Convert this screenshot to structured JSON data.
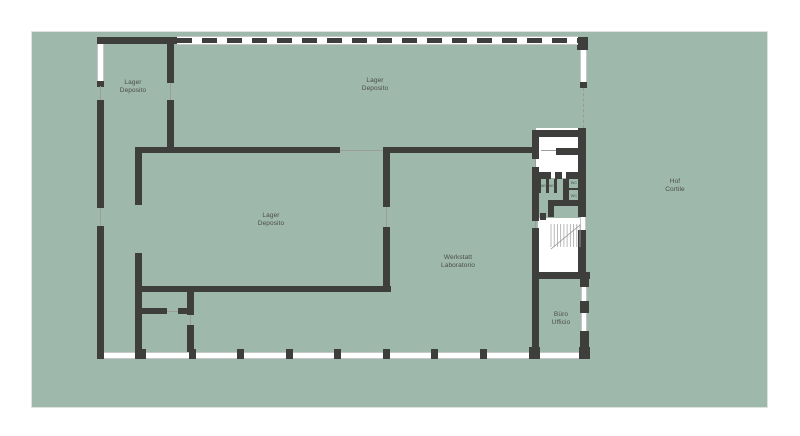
{
  "colors": {
    "page_background": "#ffffff",
    "site_field": "#9eb8ac",
    "wall": "#3e3e3c",
    "room_fill": "#ffffff",
    "window_frame": "#c7c7c7",
    "thin_line": "#9c9c9c",
    "label_text": "#4d4d4d"
  },
  "plan": {
    "field": {
      "x": 32,
      "y": 32,
      "w": 735,
      "h": 375
    },
    "dashed_wall": {
      "x": 177,
      "y": 36,
      "w": 401,
      "h": 9
    },
    "stairs": {
      "x": 551,
      "y": 224,
      "w": 29,
      "h": 25,
      "steps": 9
    },
    "rects": [
      {
        "t": "white",
        "x": 536,
        "y": 128,
        "w": 50,
        "h": 50,
        "n": "room-fill-entry"
      },
      {
        "t": "white",
        "x": 538,
        "y": 218,
        "w": 42,
        "h": 61,
        "n": "room-fill-stairwell"
      },
      {
        "t": "win-v",
        "x": 97,
        "y": 44,
        "w": 7,
        "h": 37,
        "n": "window-west-top"
      },
      {
        "t": "win-v",
        "x": 580,
        "y": 50,
        "w": 7,
        "h": 33,
        "n": "window-east-top"
      },
      {
        "t": "win-h",
        "x": 97,
        "y": 352,
        "w": 493,
        "h": 7,
        "n": "window-band-south"
      },
      {
        "t": "win-v",
        "x": 580,
        "y": 217,
        "w": 6,
        "h": 13,
        "n": "window-east-stair"
      },
      {
        "t": "win-v",
        "x": 581,
        "y": 287,
        "w": 6,
        "h": 14,
        "n": "window-east-office-1"
      },
      {
        "t": "win-v",
        "x": 581,
        "y": 313,
        "w": 6,
        "h": 18,
        "n": "window-east-office-2"
      },
      {
        "t": "wall",
        "x": 97,
        "y": 37,
        "w": 80,
        "h": 7
      },
      {
        "t": "wall",
        "x": 577,
        "y": 37,
        "w": 11,
        "h": 13
      },
      {
        "t": "wall",
        "x": 97,
        "y": 81,
        "w": 7,
        "h": 6
      },
      {
        "t": "wall",
        "x": 97,
        "y": 100,
        "w": 7,
        "h": 108
      },
      {
        "t": "wall",
        "x": 97,
        "y": 226,
        "w": 7,
        "h": 126
      },
      {
        "t": "wall",
        "x": 167,
        "y": 37,
        "w": 7,
        "h": 46
      },
      {
        "t": "wall",
        "x": 167,
        "y": 100,
        "w": 7,
        "h": 53
      },
      {
        "t": "wall",
        "x": 135,
        "y": 147,
        "w": 205,
        "h": 6
      },
      {
        "t": "wall",
        "x": 383,
        "y": 147,
        "w": 152,
        "h": 6
      },
      {
        "t": "wall",
        "x": 135,
        "y": 147,
        "w": 7,
        "h": 58
      },
      {
        "t": "wall",
        "x": 135,
        "y": 253,
        "w": 7,
        "h": 106
      },
      {
        "t": "wall",
        "x": 383,
        "y": 147,
        "w": 7,
        "h": 60
      },
      {
        "t": "wall",
        "x": 383,
        "y": 227,
        "w": 7,
        "h": 65
      },
      {
        "t": "wall",
        "x": 139,
        "y": 286,
        "w": 252,
        "h": 6
      },
      {
        "t": "wall",
        "x": 187,
        "y": 292,
        "w": 7,
        "h": 23
      },
      {
        "t": "wall",
        "x": 139,
        "y": 308,
        "w": 28,
        "h": 6
      },
      {
        "t": "wall",
        "x": 178,
        "y": 308,
        "w": 16,
        "h": 6
      },
      {
        "t": "wall",
        "x": 187,
        "y": 325,
        "w": 7,
        "h": 27
      },
      {
        "t": "wall",
        "x": 580,
        "y": 82,
        "w": 7,
        "h": 6
      },
      {
        "t": "wall",
        "x": 532,
        "y": 130,
        "w": 7,
        "h": 29
      },
      {
        "t": "wall",
        "x": 532,
        "y": 167,
        "w": 7,
        "h": 54
      },
      {
        "t": "wall",
        "x": 532,
        "y": 228,
        "w": 7,
        "h": 131
      },
      {
        "t": "wall",
        "x": 536,
        "y": 130,
        "w": 46,
        "h": 7
      },
      {
        "t": "wall",
        "x": 578,
        "y": 128,
        "w": 8,
        "h": 89
      },
      {
        "t": "wall",
        "x": 556,
        "y": 148,
        "w": 26,
        "h": 7
      },
      {
        "t": "wall",
        "x": 539,
        "y": 172,
        "w": 12,
        "h": 7
      },
      {
        "t": "wall",
        "x": 555,
        "y": 172,
        "w": 7,
        "h": 7
      },
      {
        "t": "wall",
        "x": 566,
        "y": 172,
        "w": 20,
        "h": 7
      },
      {
        "t": "wall",
        "x": 538,
        "y": 179,
        "w": 3,
        "h": 14
      },
      {
        "t": "wall",
        "x": 546,
        "y": 179,
        "w": 3,
        "h": 14
      },
      {
        "t": "wall",
        "x": 554,
        "y": 179,
        "w": 3,
        "h": 14
      },
      {
        "t": "wall",
        "x": 563,
        "y": 179,
        "w": 6,
        "h": 22
      },
      {
        "t": "wall",
        "x": 569,
        "y": 188,
        "w": 11,
        "h": 2
      },
      {
        "t": "wall",
        "x": 548,
        "y": 200,
        "w": 30,
        "h": 6
      },
      {
        "t": "wall",
        "x": 548,
        "y": 206,
        "w": 6,
        "h": 11
      },
      {
        "t": "wall",
        "x": 540,
        "y": 213,
        "w": 6,
        "h": 7
      },
      {
        "t": "wall",
        "x": 578,
        "y": 230,
        "w": 8,
        "h": 44
      },
      {
        "t": "wall",
        "x": 536,
        "y": 272,
        "w": 54,
        "h": 7
      },
      {
        "t": "wall",
        "x": 580,
        "y": 273,
        "w": 9,
        "h": 14
      },
      {
        "t": "wall",
        "x": 580,
        "y": 301,
        "w": 9,
        "h": 12
      },
      {
        "t": "wall",
        "x": 580,
        "y": 331,
        "w": 9,
        "h": 16
      },
      {
        "t": "wall",
        "x": 97,
        "y": 349,
        "w": 7,
        "h": 10
      },
      {
        "t": "wall",
        "x": 139,
        "y": 349,
        "w": 7,
        "h": 10
      },
      {
        "t": "wall",
        "x": 189,
        "y": 349,
        "w": 7,
        "h": 10
      },
      {
        "t": "wall",
        "x": 237,
        "y": 349,
        "w": 7,
        "h": 10
      },
      {
        "t": "wall",
        "x": 286,
        "y": 349,
        "w": 7,
        "h": 10
      },
      {
        "t": "wall",
        "x": 334,
        "y": 349,
        "w": 7,
        "h": 10
      },
      {
        "t": "wall",
        "x": 383,
        "y": 349,
        "w": 7,
        "h": 10
      },
      {
        "t": "wall",
        "x": 431,
        "y": 349,
        "w": 7,
        "h": 10
      },
      {
        "t": "wall",
        "x": 480,
        "y": 349,
        "w": 7,
        "h": 10
      },
      {
        "t": "wall",
        "x": 529,
        "y": 347,
        "w": 11,
        "h": 12
      },
      {
        "t": "wall",
        "x": 579,
        "y": 347,
        "w": 11,
        "h": 12
      },
      {
        "t": "line",
        "x": 100,
        "y": 86,
        "w": 1,
        "h": 14
      },
      {
        "t": "line",
        "x": 100,
        "y": 208,
        "w": 1,
        "h": 18
      },
      {
        "t": "line",
        "x": 170,
        "y": 83,
        "w": 1,
        "h": 17
      },
      {
        "t": "line",
        "x": 340,
        "y": 150,
        "w": 43,
        "h": 1
      },
      {
        "t": "line",
        "x": 386,
        "y": 207,
        "w": 1,
        "h": 20
      },
      {
        "t": "dashline",
        "x": 583,
        "y": 88,
        "w": 1,
        "h": 40
      },
      {
        "t": "line",
        "x": 167,
        "y": 311,
        "w": 11,
        "h": 1
      },
      {
        "t": "line",
        "x": 190,
        "y": 315,
        "w": 1,
        "h": 10
      },
      {
        "t": "line",
        "x": 541,
        "y": 150,
        "w": 15,
        "h": 1
      },
      {
        "t": "line",
        "x": 535,
        "y": 159,
        "w": 1,
        "h": 8
      },
      {
        "t": "line",
        "x": 535,
        "y": 221,
        "w": 1,
        "h": 7
      }
    ],
    "labels": [
      {
        "id": "lager-northwest",
        "x": 133,
        "y": 86,
        "text": "Lager\nDeposito",
        "cls": "room"
      },
      {
        "id": "lager-north",
        "x": 375,
        "y": 84,
        "text": "Lager\nDeposito",
        "cls": "room"
      },
      {
        "id": "lager-center",
        "x": 271,
        "y": 219,
        "text": "Lager\nDeposito",
        "cls": "room"
      },
      {
        "id": "werkstatt",
        "x": 458,
        "y": 261,
        "text": "Werkstatt\nLaboratorio",
        "cls": "room"
      },
      {
        "id": "buero",
        "x": 561,
        "y": 318,
        "text": "Büro\nUfficio",
        "cls": "room"
      },
      {
        "id": "hof",
        "x": 675,
        "y": 185,
        "text": "Hof\nCortile",
        "cls": "room"
      },
      {
        "id": "wc-1",
        "x": 544,
        "y": 186,
        "text": "WC",
        "cls": "tiny"
      },
      {
        "id": "wc-2",
        "x": 552,
        "y": 186,
        "text": "WC",
        "cls": "tiny"
      },
      {
        "id": "wc-3",
        "x": 574,
        "y": 183,
        "text": "WC",
        "cls": "tiny"
      },
      {
        "id": "wc-4",
        "x": 574,
        "y": 196,
        "text": "WC",
        "cls": "tiny"
      }
    ]
  }
}
